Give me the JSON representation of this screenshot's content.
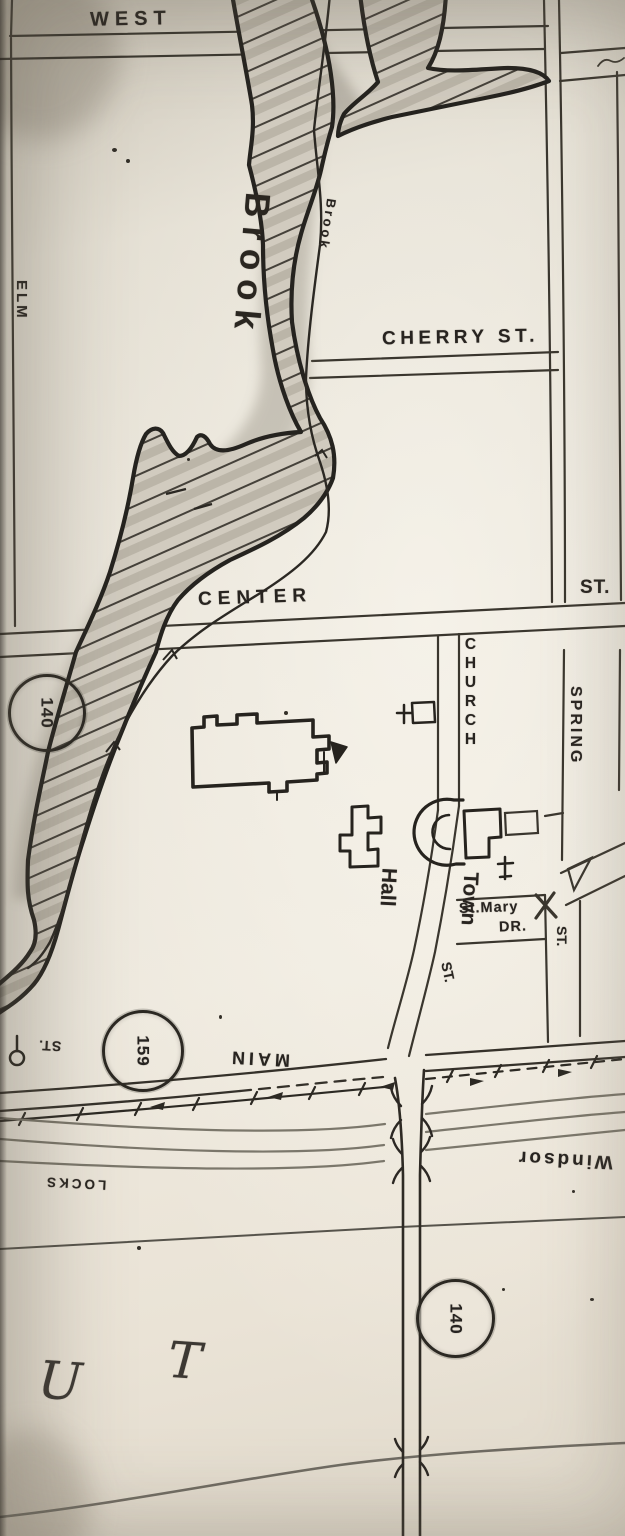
{
  "map": {
    "description": "Scanned hand-inked town street map photograph",
    "streets": {
      "west": "WEST",
      "elm": "ELM",
      "cherry": "CHERRY ST.",
      "center": "CENTER",
      "center_st_suffix": "ST.",
      "church": "CHURCH",
      "spring": "SPRING",
      "spring_st_suffix": "ST.",
      "church_st_suffix": "ST.",
      "st_mary_line1": "St.Mary",
      "st_mary_line2": "DR.",
      "main": "MAIN",
      "left_st_upside_down": "ST."
    },
    "water": {
      "brook_label": "Brook",
      "brook_small_label": "Brook"
    },
    "places": {
      "town_hall_line1": "Town",
      "town_hall_line2": "Hall"
    },
    "route_markers": {
      "route_140_west": "140",
      "route_159": "159",
      "route_140_south": "140"
    },
    "boundary_labels": {
      "windsor": "Windsor",
      "locks": "LOCKS"
    },
    "large_area_letters": {
      "u": "U",
      "t": "T"
    }
  }
}
